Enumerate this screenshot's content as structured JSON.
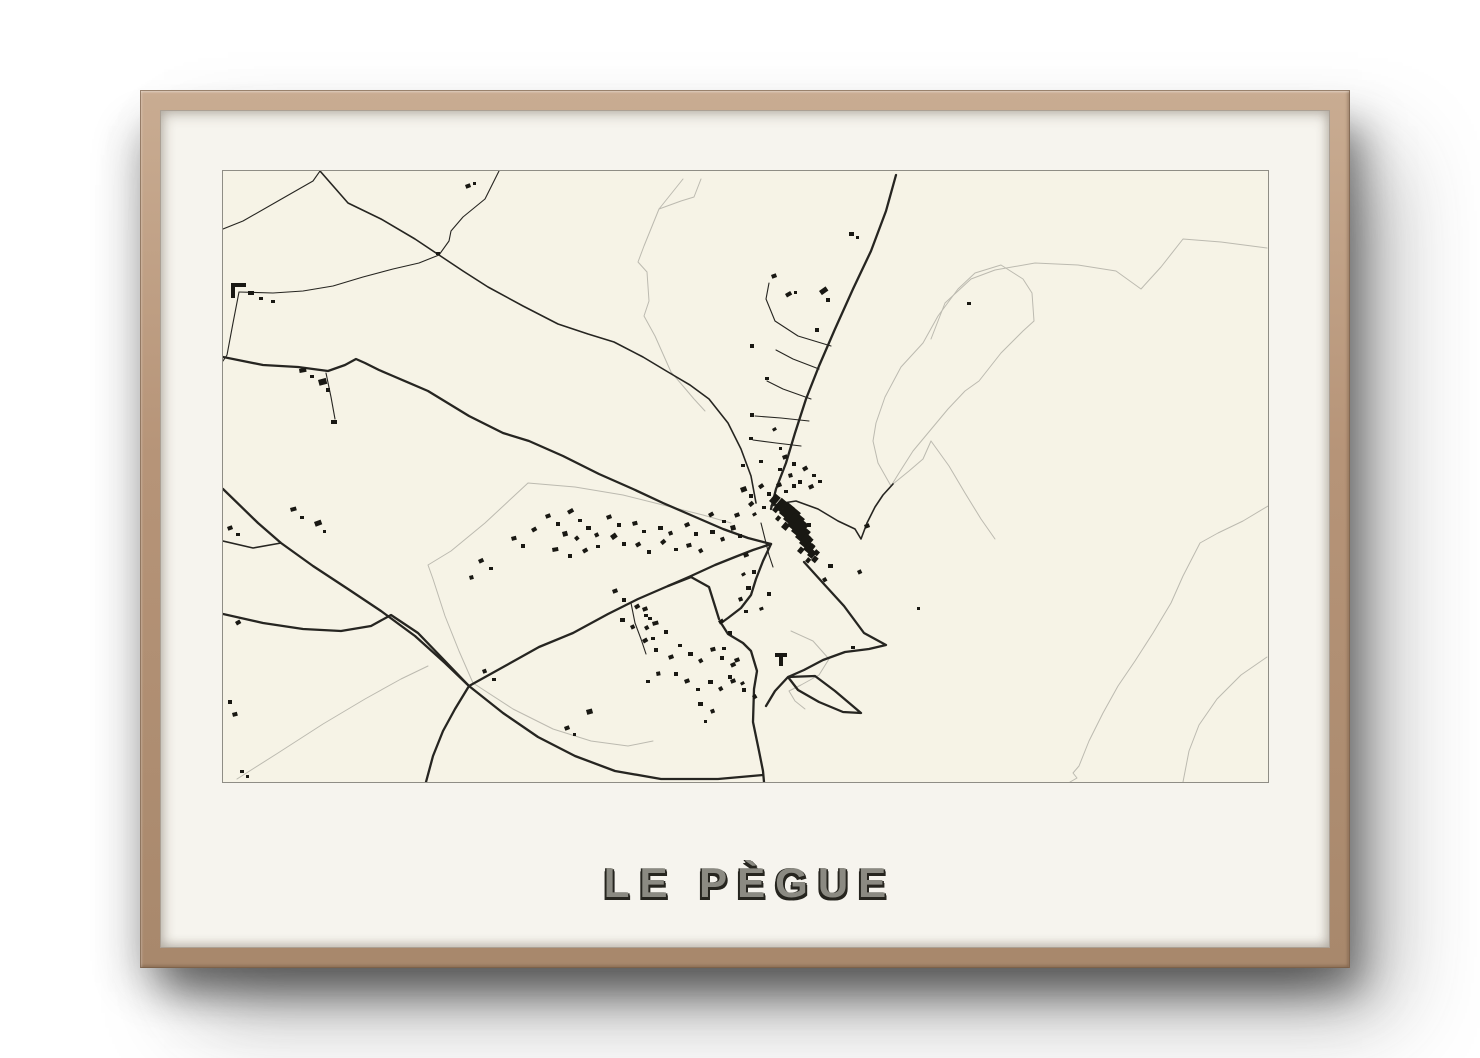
{
  "poster": {
    "title": "LE PÈGUE",
    "colors": {
      "mat": "#f6f4ee",
      "map_bg": "#f6f3e6",
      "map_border": "#8f8d85",
      "frame_wood": "#b69478",
      "road": "#262521",
      "faint": "#bcbab0",
      "building": "#191813",
      "title_fill": "#8b8a82",
      "title_shadow": "#26251f"
    }
  },
  "map": {
    "viewbox": [
      1045,
      611
    ],
    "layers": [
      {
        "name": "faint-boundaries",
        "color": "#bcbab0",
        "width": 1,
        "paths": [
          "708,168 722,132 748,108 772,99 812,92 855,94 893,100 918,118 938,96 960,68 998,71 1044,77",
          "778,94 752,102 735,118 715,145 700,172 678,196 662,226 653,252 650,270 655,292 668,315 676,302 690,280 705,262 725,238 742,220 756,210 778,182 800,160 811,150 809,122 800,108 778,94",
          "1045,335 1020,350 995,362 977,372 960,405 948,432 930,462 912,490 895,515 880,542 866,570 856,595 850,602 854,607 847,611",
          "1044,486 1018,504 994,528 976,554 966,580 960,611",
          "670,313 686,300 700,288 708,270",
          "708,270 726,295 742,322 758,348 772,368",
          "460,8 436,38 421,75 415,91 424,101 426,130 421,145 432,165 440,183 448,201 460,215 471,228 482,240",
          "436,38 458,30 471,26 478,8",
          "14,608 55,582 100,553 142,528 178,508 205,495",
          "448,336 400,324 352,316 305,312 262,352 228,380 205,394 210,408 222,445 236,480 250,512",
          "250,512 290,538 330,558 368,570 405,575 430,570",
          "448,336 480,344 508,352",
          "568,460 590,470 606,488 596,504 578,514 566,520 572,530 582,538"
        ]
      },
      {
        "name": "thin-roads",
        "color": "#262521",
        "width": 1.1,
        "paths": [
          "276,0 262,28 240,46 228,60 226,70 216,84",
          "97,0 90,10 55,30 20,50 0,58",
          "216,84 196,92 170,98 140,106 110,115 80,120 50,122 16,121",
          "16,121 10,152 4,184 0,190",
          "103,202 108,226 112,248",
          "608,175 575,165 552,150 543,128 546,112",
          "596,198 570,188 553,179",
          "588,228 560,218 544,210",
          "586,250 558,247 532,245",
          "578,275 553,272 530,269",
          "408,432 412,452 418,468 423,483",
          "538,352 542,368 546,384 550,396"
        ]
      },
      {
        "name": "medium-roads",
        "color": "#262521",
        "width": 1.6,
        "paths": [
          "97,0 125,32 158,48 192,68 216,84 240,100 265,116 300,135 335,153 365,163 391,171 420,186 445,201 467,214 486,228 505,252 518,278 528,305 533,332",
          "548,335 560,332 573,330 595,338 615,350 632,358 638,368 644,352 652,336 660,324 670,313",
          "0,370 30,377 58,372"
        ]
      },
      {
        "name": "main-roads",
        "color": "#262521",
        "width": 2.3,
        "paths": [
          "673,4 663,40 648,80 630,118 612,158 596,195 583,228 572,262 563,292 553,318 548,338",
          "0,186 40,194 75,196 105,200 122,194 133,188 142,192 156,199 170,205 205,220 246,245 280,262 306,270 340,285 376,303 410,318 440,332 470,345 500,358 525,367 548,373",
          "0,318 35,352 58,372 90,395 125,418 158,440 192,465 222,492 246,515",
          "246,515 280,542 315,566 352,585 392,600 438,608 495,608 540,604",
          "0,443 40,452 80,458 118,460 148,455 168,444 195,462 222,490 246,515",
          "246,515 282,495 316,476 350,462 385,443 415,428 445,415 468,406 486,416 496,448",
          "445,415 468,405 492,394 512,386 530,379 548,373",
          "246,515 232,538 220,560 210,585 203,611",
          "548,373 540,390 533,408 528,424 518,437 505,447 498,452 505,463 520,472 528,480 534,500 531,518 530,551 536,580 540,600 541,611",
          "581,391 600,412 621,435 641,462 663,474 646,478 622,481 600,489 581,499 565,506 592,505 612,520 638,542 620,541 596,531 575,519 565,506 552,520 543,535"
        ]
      }
    ],
    "buildings": [
      [
        8,
        112,
        15,
        4,
        0
      ],
      [
        8,
        116,
        4,
        11,
        0
      ],
      [
        25,
        120,
        6,
        4,
        0
      ],
      [
        36,
        126,
        4,
        3,
        0
      ],
      [
        48,
        129,
        4,
        3,
        0
      ],
      [
        213,
        81,
        4,
        3,
        0
      ],
      [
        242,
        14,
        5,
        4,
        -20
      ],
      [
        250,
        11,
        3,
        3,
        0
      ],
      [
        626,
        61,
        5,
        4,
        0
      ],
      [
        633,
        65,
        3,
        3,
        0
      ],
      [
        562,
        123,
        6,
        4,
        -30
      ],
      [
        571,
        120,
        3,
        3,
        0
      ],
      [
        596,
        120,
        8,
        5,
        -35
      ],
      [
        603,
        127,
        4,
        4,
        0
      ],
      [
        744,
        131,
        4,
        3,
        0
      ],
      [
        548,
        104,
        5,
        4,
        -20
      ],
      [
        527,
        173,
        4,
        4,
        0
      ],
      [
        542,
        206,
        4,
        3,
        0
      ],
      [
        527,
        242,
        4,
        4,
        0
      ],
      [
        526,
        266,
        4,
        3,
        0
      ],
      [
        549,
        258,
        4,
        3,
        -30
      ],
      [
        556,
        276,
        3,
        3,
        0
      ],
      [
        592,
        157,
        4,
        4,
        0
      ],
      [
        536,
        289,
        4,
        3,
        0
      ],
      [
        518,
        293,
        4,
        3,
        0
      ],
      [
        76,
        198,
        7,
        4,
        -10
      ],
      [
        87,
        204,
        4,
        3,
        0
      ],
      [
        95,
        209,
        8,
        6,
        -15
      ],
      [
        103,
        217,
        4,
        4,
        0
      ],
      [
        108,
        249,
        6,
        4,
        0
      ],
      [
        67,
        337,
        6,
        4,
        -15
      ],
      [
        77,
        345,
        4,
        3,
        0
      ],
      [
        91,
        351,
        7,
        5,
        -20
      ],
      [
        100,
        359,
        3,
        3,
        0
      ],
      [
        4,
        356,
        5,
        4,
        -20
      ],
      [
        13,
        362,
        4,
        3,
        0
      ],
      [
        12,
        451,
        5,
        4,
        -30
      ],
      [
        5,
        529,
        4,
        4,
        0
      ],
      [
        9,
        542,
        5,
        4,
        -15
      ],
      [
        17,
        599,
        4,
        3,
        0
      ],
      [
        23,
        604,
        3,
        3,
        0
      ],
      [
        255,
        389,
        5,
        4,
        -25
      ],
      [
        266,
        396,
        4,
        3,
        0
      ],
      [
        246,
        405,
        4,
        4,
        -15
      ],
      [
        288,
        366,
        5,
        4,
        -15
      ],
      [
        298,
        373,
        4,
        4,
        0
      ],
      [
        308,
        358,
        5,
        4,
        -30
      ],
      [
        322,
        344,
        5,
        4,
        -20
      ],
      [
        333,
        351,
        4,
        4,
        0
      ],
      [
        344,
        340,
        6,
        4,
        -30
      ],
      [
        355,
        348,
        4,
        3,
        0
      ],
      [
        339,
        361,
        5,
        5,
        -15
      ],
      [
        351,
        367,
        4,
        4,
        -40
      ],
      [
        363,
        355,
        5,
        4,
        0
      ],
      [
        371,
        363,
        4,
        4,
        -25
      ],
      [
        329,
        377,
        6,
        4,
        -10
      ],
      [
        345,
        383,
        4,
        4,
        0
      ],
      [
        359,
        379,
        5,
        4,
        -30
      ],
      [
        373,
        374,
        4,
        3,
        0
      ],
      [
        383,
        345,
        5,
        4,
        -20
      ],
      [
        394,
        352,
        4,
        4,
        0
      ],
      [
        387,
        365,
        6,
        5,
        -35
      ],
      [
        399,
        371,
        4,
        4,
        0
      ],
      [
        409,
        351,
        5,
        4,
        -15
      ],
      [
        419,
        359,
        4,
        3,
        0
      ],
      [
        412,
        373,
        5,
        4,
        -30
      ],
      [
        424,
        379,
        4,
        4,
        0
      ],
      [
        435,
        355,
        5,
        4,
        0
      ],
      [
        445,
        361,
        4,
        4,
        -20
      ],
      [
        437,
        371,
        5,
        4,
        -40
      ],
      [
        451,
        377,
        4,
        3,
        0
      ],
      [
        461,
        353,
        5,
        4,
        -25
      ],
      [
        471,
        361,
        4,
        4,
        0
      ],
      [
        463,
        373,
        5,
        4,
        -15
      ],
      [
        475,
        379,
        4,
        4,
        -30
      ],
      [
        487,
        359,
        5,
        4,
        0
      ],
      [
        497,
        367,
        4,
        4,
        -20
      ],
      [
        485,
        343,
        5,
        4,
        -30
      ],
      [
        499,
        349,
        4,
        3,
        0
      ],
      [
        507,
        355,
        5,
        5,
        -15
      ],
      [
        515,
        363,
        4,
        4,
        0
      ],
      [
        517,
        317,
        6,
        5,
        -20
      ],
      [
        526,
        323,
        4,
        4,
        0
      ],
      [
        535,
        315,
        5,
        4,
        -35
      ],
      [
        544,
        321,
        4,
        4,
        0
      ],
      [
        553,
        313,
        5,
        4,
        -20
      ],
      [
        561,
        319,
        4,
        3,
        0
      ],
      [
        569,
        313,
        4,
        4,
        0
      ],
      [
        525,
        333,
        5,
        4,
        -40
      ],
      [
        539,
        335,
        4,
        3,
        0
      ],
      [
        511,
        343,
        5,
        4,
        -20
      ],
      [
        529,
        343,
        4,
        3,
        -30
      ],
      [
        559,
        285,
        5,
        4,
        -20
      ],
      [
        569,
        291,
        4,
        4,
        0
      ],
      [
        579,
        297,
        5,
        4,
        -30
      ],
      [
        589,
        303,
        4,
        3,
        0
      ],
      [
        565,
        303,
        4,
        4,
        -15
      ],
      [
        575,
        309,
        4,
        4,
        0
      ],
      [
        585,
        315,
        5,
        4,
        -25
      ],
      [
        595,
        309,
        4,
        3,
        0
      ],
      [
        555,
        297,
        4,
        3,
        0
      ],
      [
        546,
        330,
        10,
        7,
        -50
      ],
      [
        551,
        336,
        12,
        8,
        -50
      ],
      [
        556,
        342,
        14,
        9,
        -50
      ],
      [
        560,
        348,
        16,
        10,
        -50
      ],
      [
        564,
        354,
        16,
        10,
        -50
      ],
      [
        568,
        360,
        16,
        10,
        -50
      ],
      [
        572,
        366,
        14,
        9,
        -50
      ],
      [
        576,
        372,
        12,
        9,
        -50
      ],
      [
        580,
        378,
        10,
        8,
        -50
      ],
      [
        584,
        384,
        8,
        6,
        -50
      ],
      [
        588,
        389,
        6,
        5,
        -50
      ],
      [
        549,
        339,
        6,
        5,
        -50
      ],
      [
        578,
        368,
        8,
        7,
        -50
      ],
      [
        566,
        348,
        8,
        7,
        -50
      ],
      [
        558,
        356,
        7,
        6,
        -50
      ],
      [
        574,
        380,
        6,
        5,
        -50
      ],
      [
        586,
        376,
        5,
        4,
        -50
      ],
      [
        552,
        348,
        5,
        4,
        -50
      ],
      [
        590,
        382,
        5,
        5,
        -50
      ],
      [
        582,
        390,
        5,
        4,
        -50
      ],
      [
        520,
        383,
        5,
        4,
        -20
      ],
      [
        529,
        399,
        4,
        4,
        0
      ],
      [
        518,
        403,
        4,
        3,
        -30
      ],
      [
        523,
        415,
        5,
        4,
        0
      ],
      [
        515,
        427,
        4,
        4,
        -20
      ],
      [
        521,
        439,
        4,
        3,
        0
      ],
      [
        584,
        352,
        4,
        4,
        0
      ],
      [
        641,
        354,
        5,
        4,
        -20
      ],
      [
        694,
        436,
        3,
        3,
        0
      ],
      [
        634,
        400,
        4,
        4,
        -25
      ],
      [
        605,
        393,
        5,
        4,
        0
      ],
      [
        599,
        408,
        4,
        4,
        -30
      ],
      [
        628,
        475,
        4,
        3,
        0
      ],
      [
        389,
        419,
        5,
        4,
        -20
      ],
      [
        399,
        427,
        4,
        4,
        0
      ],
      [
        411,
        435,
        5,
        4,
        -30
      ],
      [
        421,
        443,
        4,
        3,
        0
      ],
      [
        397,
        447,
        5,
        4,
        0
      ],
      [
        407,
        455,
        4,
        4,
        -25
      ],
      [
        429,
        451,
        6,
        4,
        -15
      ],
      [
        441,
        459,
        4,
        4,
        0
      ],
      [
        419,
        469,
        5,
        4,
        -30
      ],
      [
        431,
        477,
        4,
        4,
        0
      ],
      [
        445,
        485,
        5,
        4,
        -20
      ],
      [
        455,
        473,
        4,
        3,
        0
      ],
      [
        465,
        481,
        5,
        4,
        0
      ],
      [
        475,
        489,
        4,
        4,
        -30
      ],
      [
        487,
        477,
        5,
        4,
        -15
      ],
      [
        497,
        485,
        4,
        4,
        0
      ],
      [
        507,
        493,
        5,
        4,
        -25
      ],
      [
        451,
        501,
        4,
        4,
        0
      ],
      [
        461,
        509,
        5,
        4,
        -20
      ],
      [
        473,
        517,
        4,
        3,
        0
      ],
      [
        485,
        509,
        5,
        4,
        0
      ],
      [
        495,
        517,
        4,
        4,
        -30
      ],
      [
        433,
        501,
        4,
        4,
        -10
      ],
      [
        423,
        509,
        4,
        3,
        0
      ],
      [
        507,
        509,
        5,
        4,
        -20
      ],
      [
        519,
        517,
        4,
        4,
        0
      ],
      [
        529,
        525,
        4,
        4,
        -30
      ],
      [
        475,
        531,
        5,
        4,
        0
      ],
      [
        487,
        539,
        4,
        4,
        -20
      ],
      [
        552,
        482,
        12,
        4,
        0
      ],
      [
        556,
        486,
        4,
        9,
        0
      ],
      [
        341,
        556,
        5,
        4,
        -20
      ],
      [
        350,
        562,
        3,
        3,
        0
      ],
      [
        363,
        539,
        6,
        5,
        -15
      ],
      [
        481,
        549,
        3,
        3,
        0
      ],
      [
        259,
        499,
        4,
        4,
        -20
      ],
      [
        269,
        507,
        4,
        3,
        0
      ],
      [
        419,
        437,
        5,
        4,
        -20
      ],
      [
        425,
        446,
        4,
        3,
        0
      ],
      [
        421,
        456,
        4,
        4,
        -30
      ],
      [
        428,
        466,
        4,
        3,
        0
      ],
      [
        495,
        450,
        5,
        4,
        -30
      ],
      [
        505,
        460,
        4,
        4,
        0
      ],
      [
        499,
        476,
        4,
        3,
        0
      ],
      [
        511,
        488,
        5,
        4,
        -20
      ],
      [
        505,
        504,
        4,
        4,
        0
      ],
      [
        517,
        512,
        4,
        3,
        -30
      ],
      [
        544,
        421,
        4,
        4,
        0
      ],
      [
        536,
        437,
        4,
        3,
        -20
      ]
    ]
  }
}
